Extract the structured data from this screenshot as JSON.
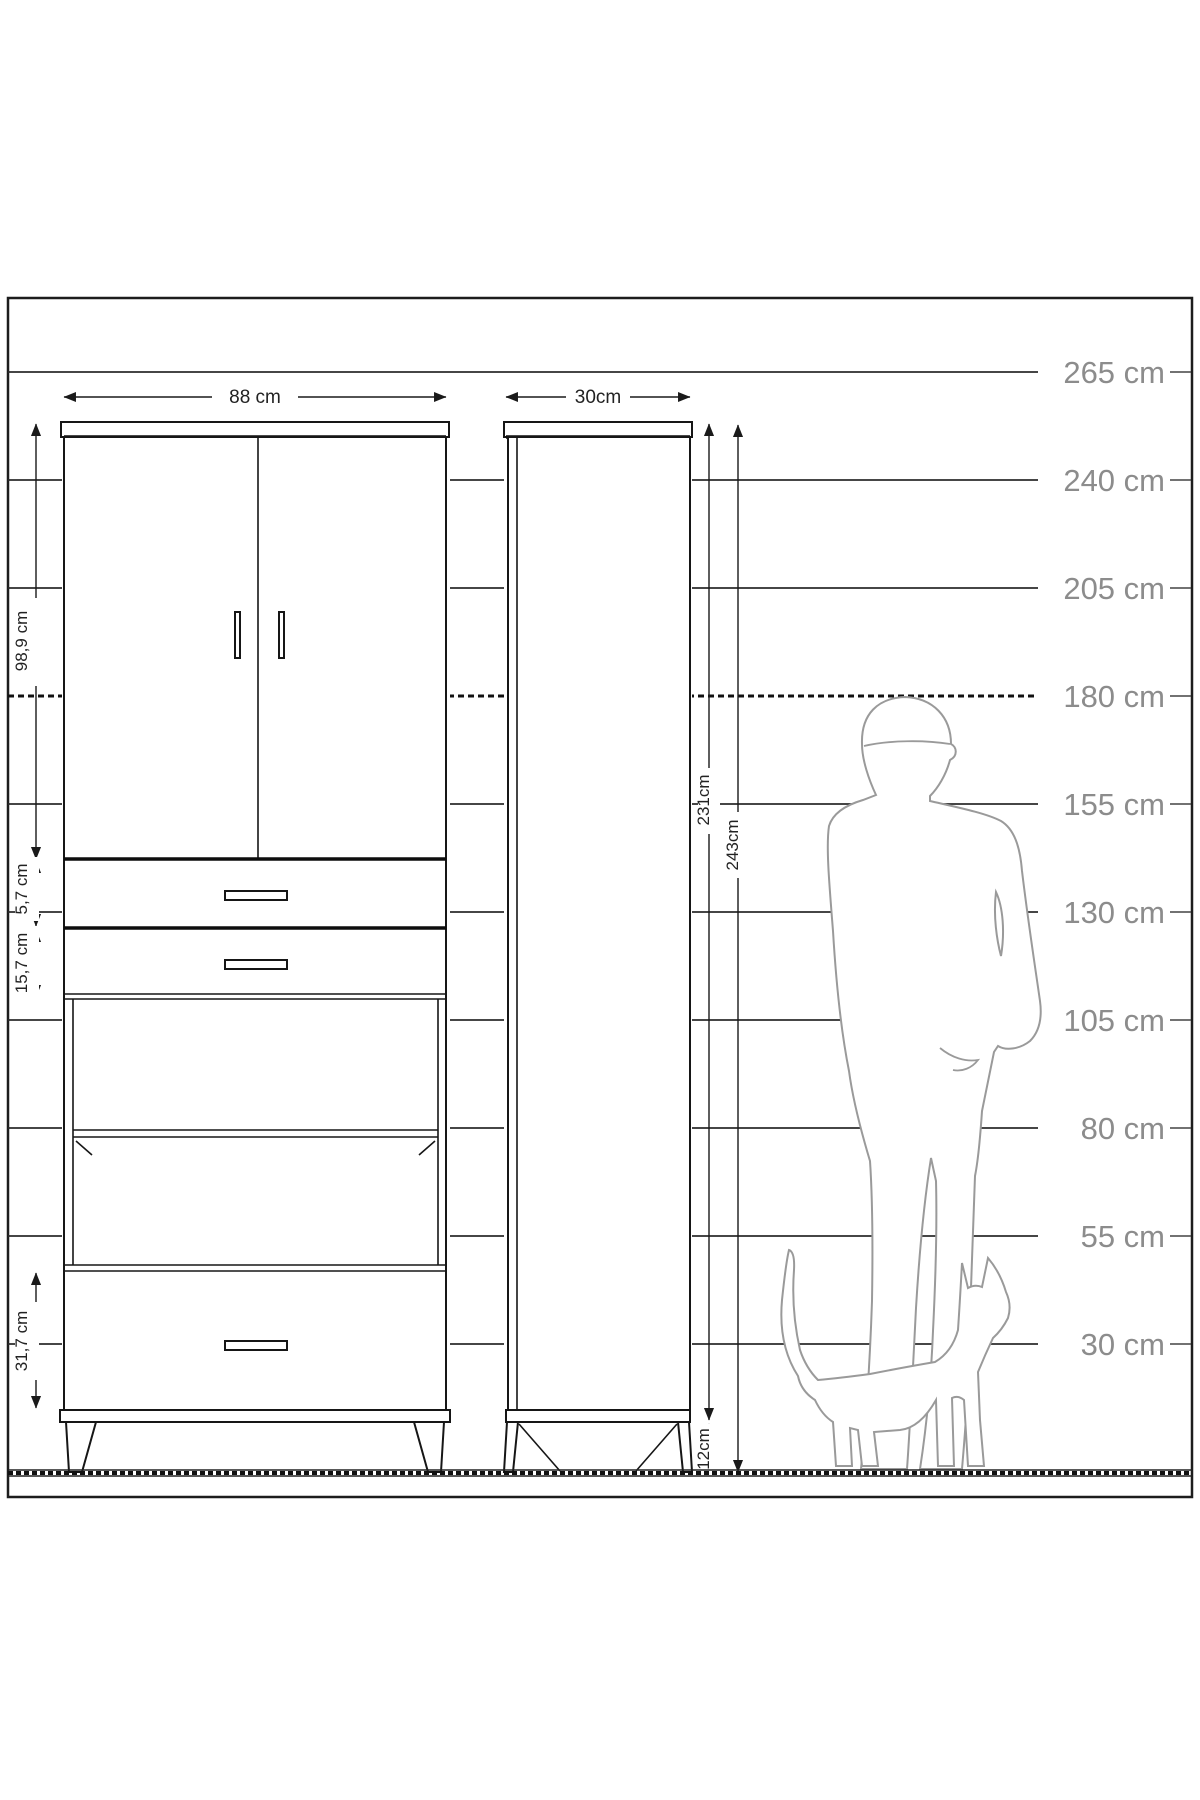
{
  "title": "wardrobe-technical-dimension-drawing",
  "colors": {
    "background": "#ffffff",
    "drawing_line": "#1a1a1a",
    "scale_label": "#8c8c8c",
    "silhouette_outline": "#9a9a9a"
  },
  "scale_labels": [
    "265 cm",
    "240 cm",
    "205 cm",
    "180 cm",
    "155 cm",
    "130 cm",
    "105 cm",
    "80 cm",
    "55 cm",
    "30 cm"
  ],
  "dimensions": {
    "front_width": "88 cm",
    "side_depth": "30cm",
    "door_section_height": "98,9 cm",
    "top_drawer_height": "5,7 cm",
    "second_drawer_height": "15,7 cm",
    "bottom_drawer_height": "31,7 cm",
    "carcass_height": "231cm",
    "total_height": "243cm",
    "leg_height": "12cm"
  }
}
